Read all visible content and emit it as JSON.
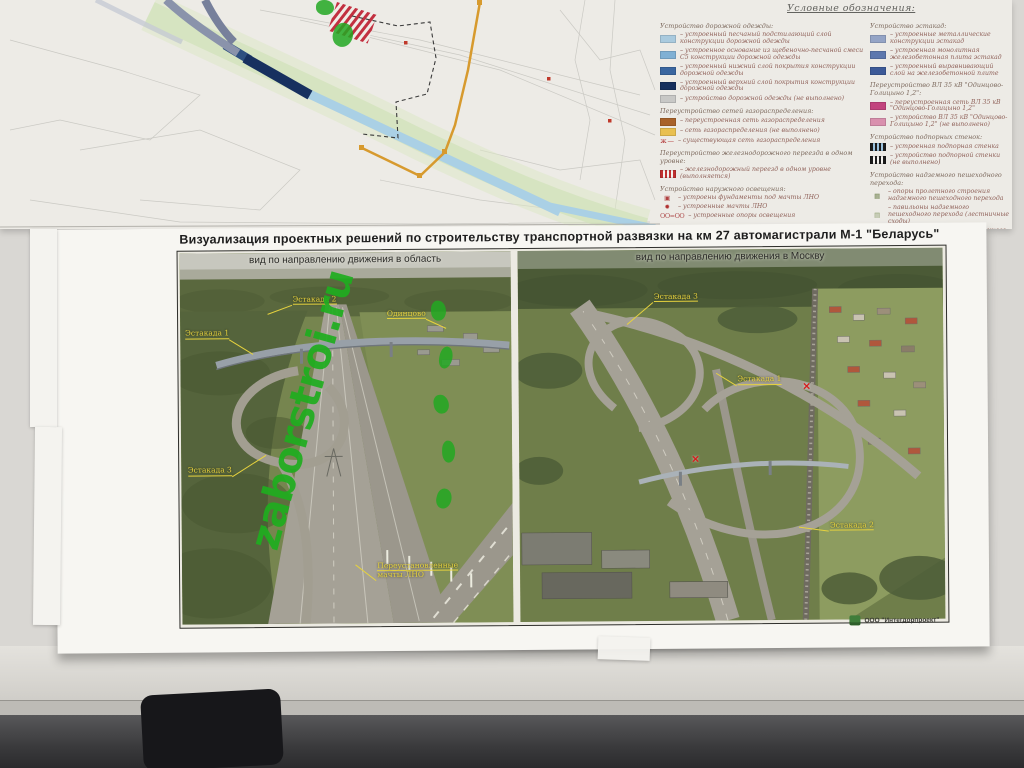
{
  "legend": {
    "title": "Условные обозначения:",
    "col_left": [
      {
        "header": "Устройство дорожной одежды:",
        "items": [
          {
            "type": "box",
            "color": "#a9cade",
            "label": "устроенный песчаный подстилающий слой конструкции дорожной одежды"
          },
          {
            "type": "box",
            "color": "#7fb0d4",
            "label": "устроенное основание из щебеночно-песчаной смеси С5 конструкции дорожной одежды"
          },
          {
            "type": "box",
            "color": "#3a66a0",
            "label": "устроенный нижний слой покрытия конструкции дорожной одежды"
          },
          {
            "type": "box",
            "color": "#16305e",
            "label": "устроенный верхний слой покрытия конструкции дорожной одежды"
          },
          {
            "type": "box",
            "color": "#c8c8c6",
            "label": "устройство дорожной одежды (не выполнено)"
          }
        ]
      },
      {
        "header": "Переустройство сетей газораспределения:",
        "items": [
          {
            "type": "box",
            "color": "#a8622a",
            "label": "переустроенная сеть газораспределения"
          },
          {
            "type": "box",
            "color": "#e9c050",
            "label": "сеть газораспределения (не выполнено)"
          },
          {
            "type": "glyph",
            "glyph": "ж —",
            "color": "#b03030",
            "label": "существующая сеть газораспределения"
          }
        ]
      },
      {
        "header": "Переустройство железнодорожного переезда в одном уровне:",
        "items": [
          {
            "type": "hatch",
            "color": "#c03030",
            "bg": "#f5f3ef",
            "label": "железнодорожный переезд в одном уровне (выполняется)"
          }
        ]
      },
      {
        "header": "Устройство наружного освещения:",
        "items": [
          {
            "type": "glyph",
            "glyph": "▣",
            "color": "#b04040",
            "label": "устроены фундаменты под мачты ЛНО"
          },
          {
            "type": "glyph",
            "glyph": "✹",
            "color": "#b03030",
            "label": "устроенные мачты ЛНО"
          },
          {
            "type": "glyph",
            "glyph": "OO=OO",
            "color": "#b05050",
            "label": "устроенные опоры освещения"
          }
        ]
      }
    ],
    "col_right": [
      {
        "header": "Устройство эстакад:",
        "items": [
          {
            "type": "box",
            "color": "#94a4c6",
            "label": "устроенные металлические конструкции эстакад"
          },
          {
            "type": "box",
            "color": "#5d78ae",
            "label": "устроенная монолитная железобетонная плита эстакад"
          },
          {
            "type": "box",
            "color": "#3d5a98",
            "label": "устроенный выравнивающий слой на железобетонной плите"
          }
        ]
      },
      {
        "header": "Переустройство ВЛ 35 кВ \"Одинцово-Голицыно 1,2\":",
        "items": [
          {
            "type": "box",
            "color": "#c2447e",
            "label": "переустроенная сеть ВЛ 35 кВ \"Одинцово-Голицыно 1,2\""
          },
          {
            "type": "box",
            "color": "#d990ae",
            "label": "устройство ВЛ 35 кВ \"Одинцово-Голицыно 1,2\" (не выполнено)"
          }
        ]
      },
      {
        "header": "Устройство подпорных стенок:",
        "items": [
          {
            "type": "hatch",
            "color": "#1c1c1c",
            "bg": "#9cc4e0",
            "label": "устроенная подпорная стенка"
          },
          {
            "type": "hatch",
            "color": "#1c1c1c",
            "bg": "#f5f3ef",
            "label": "устройство подпорной стенки (не выполнено)"
          }
        ]
      },
      {
        "header": "Устройство надземного пешеходного перехода:",
        "items": [
          {
            "type": "glyph",
            "glyph": "▦",
            "color": "#7a8a5a",
            "label": "опоры пролетного строения надземного пешеходного перехода"
          },
          {
            "type": "glyph",
            "glyph": "▤",
            "color": "#8a9a6a",
            "label": "павильоны надземного пешеходного перехода (лестничные сходы)"
          },
          {
            "type": "glyph",
            "glyph": "▭",
            "color": "#9a9a8e",
            "label": "пролетные строения надземного пешеходного перехода"
          }
        ]
      }
    ]
  },
  "poster": {
    "title": "Визуализация проектных решений по строительству транспортной развязки на км 27 автомагистрали М-1 \"Беларусь\"",
    "left_panel": {
      "caption": "вид по направлению движения в область",
      "labels": [
        {
          "lines": [
            "Эстакада 2"
          ],
          "x": 34,
          "y": 11.5,
          "leader": {
            "ang": 160,
            "len": 26
          }
        },
        {
          "lines": [
            "Одинцово"
          ],
          "x": 62.5,
          "y": 15.5,
          "leader": {
            "ang": 25,
            "len": 22,
            "side": "r"
          }
        },
        {
          "lines": [
            "Эстакада 1"
          ],
          "x": 1.5,
          "y": 20.5,
          "leader": {
            "ang": 32,
            "len": 28,
            "side": "r"
          }
        },
        {
          "lines": [
            "Эстакада 3"
          ],
          "x": 2,
          "y": 57.5,
          "leader": {
            "ang": -32,
            "len": 40,
            "side": "r"
          }
        },
        {
          "lines": [
            "Переустановленные",
            "мачты ЛНО"
          ],
          "x": 59,
          "y": 83.5,
          "leader": {
            "ang": -142,
            "len": 26
          }
        }
      ],
      "markers": []
    },
    "right_panel": {
      "caption": "вид по направлению движения в Москву",
      "labels": [
        {
          "lines": [
            "Эстакада 3"
          ],
          "x": 32,
          "y": 11.5,
          "leader": {
            "ang": 140,
            "len": 34
          }
        },
        {
          "lines": [
            "Эстакада 1"
          ],
          "x": 51.5,
          "y": 34,
          "leader": {
            "ang": 212,
            "len": 24
          }
        },
        {
          "lines": [
            "Эстакада 2"
          ],
          "x": 73,
          "y": 73.5,
          "leader": {
            "ang": 188,
            "len": 30
          }
        }
      ],
      "markers": [
        {
          "x": 66.8,
          "y": 35.8
        },
        {
          "x": 40.5,
          "y": 55.2
        }
      ]
    },
    "logo_text": "ООО \"Интегдорпроект\""
  },
  "watermark": {
    "text": "zaborstroi.ru",
    "color": "#1fae1f"
  }
}
